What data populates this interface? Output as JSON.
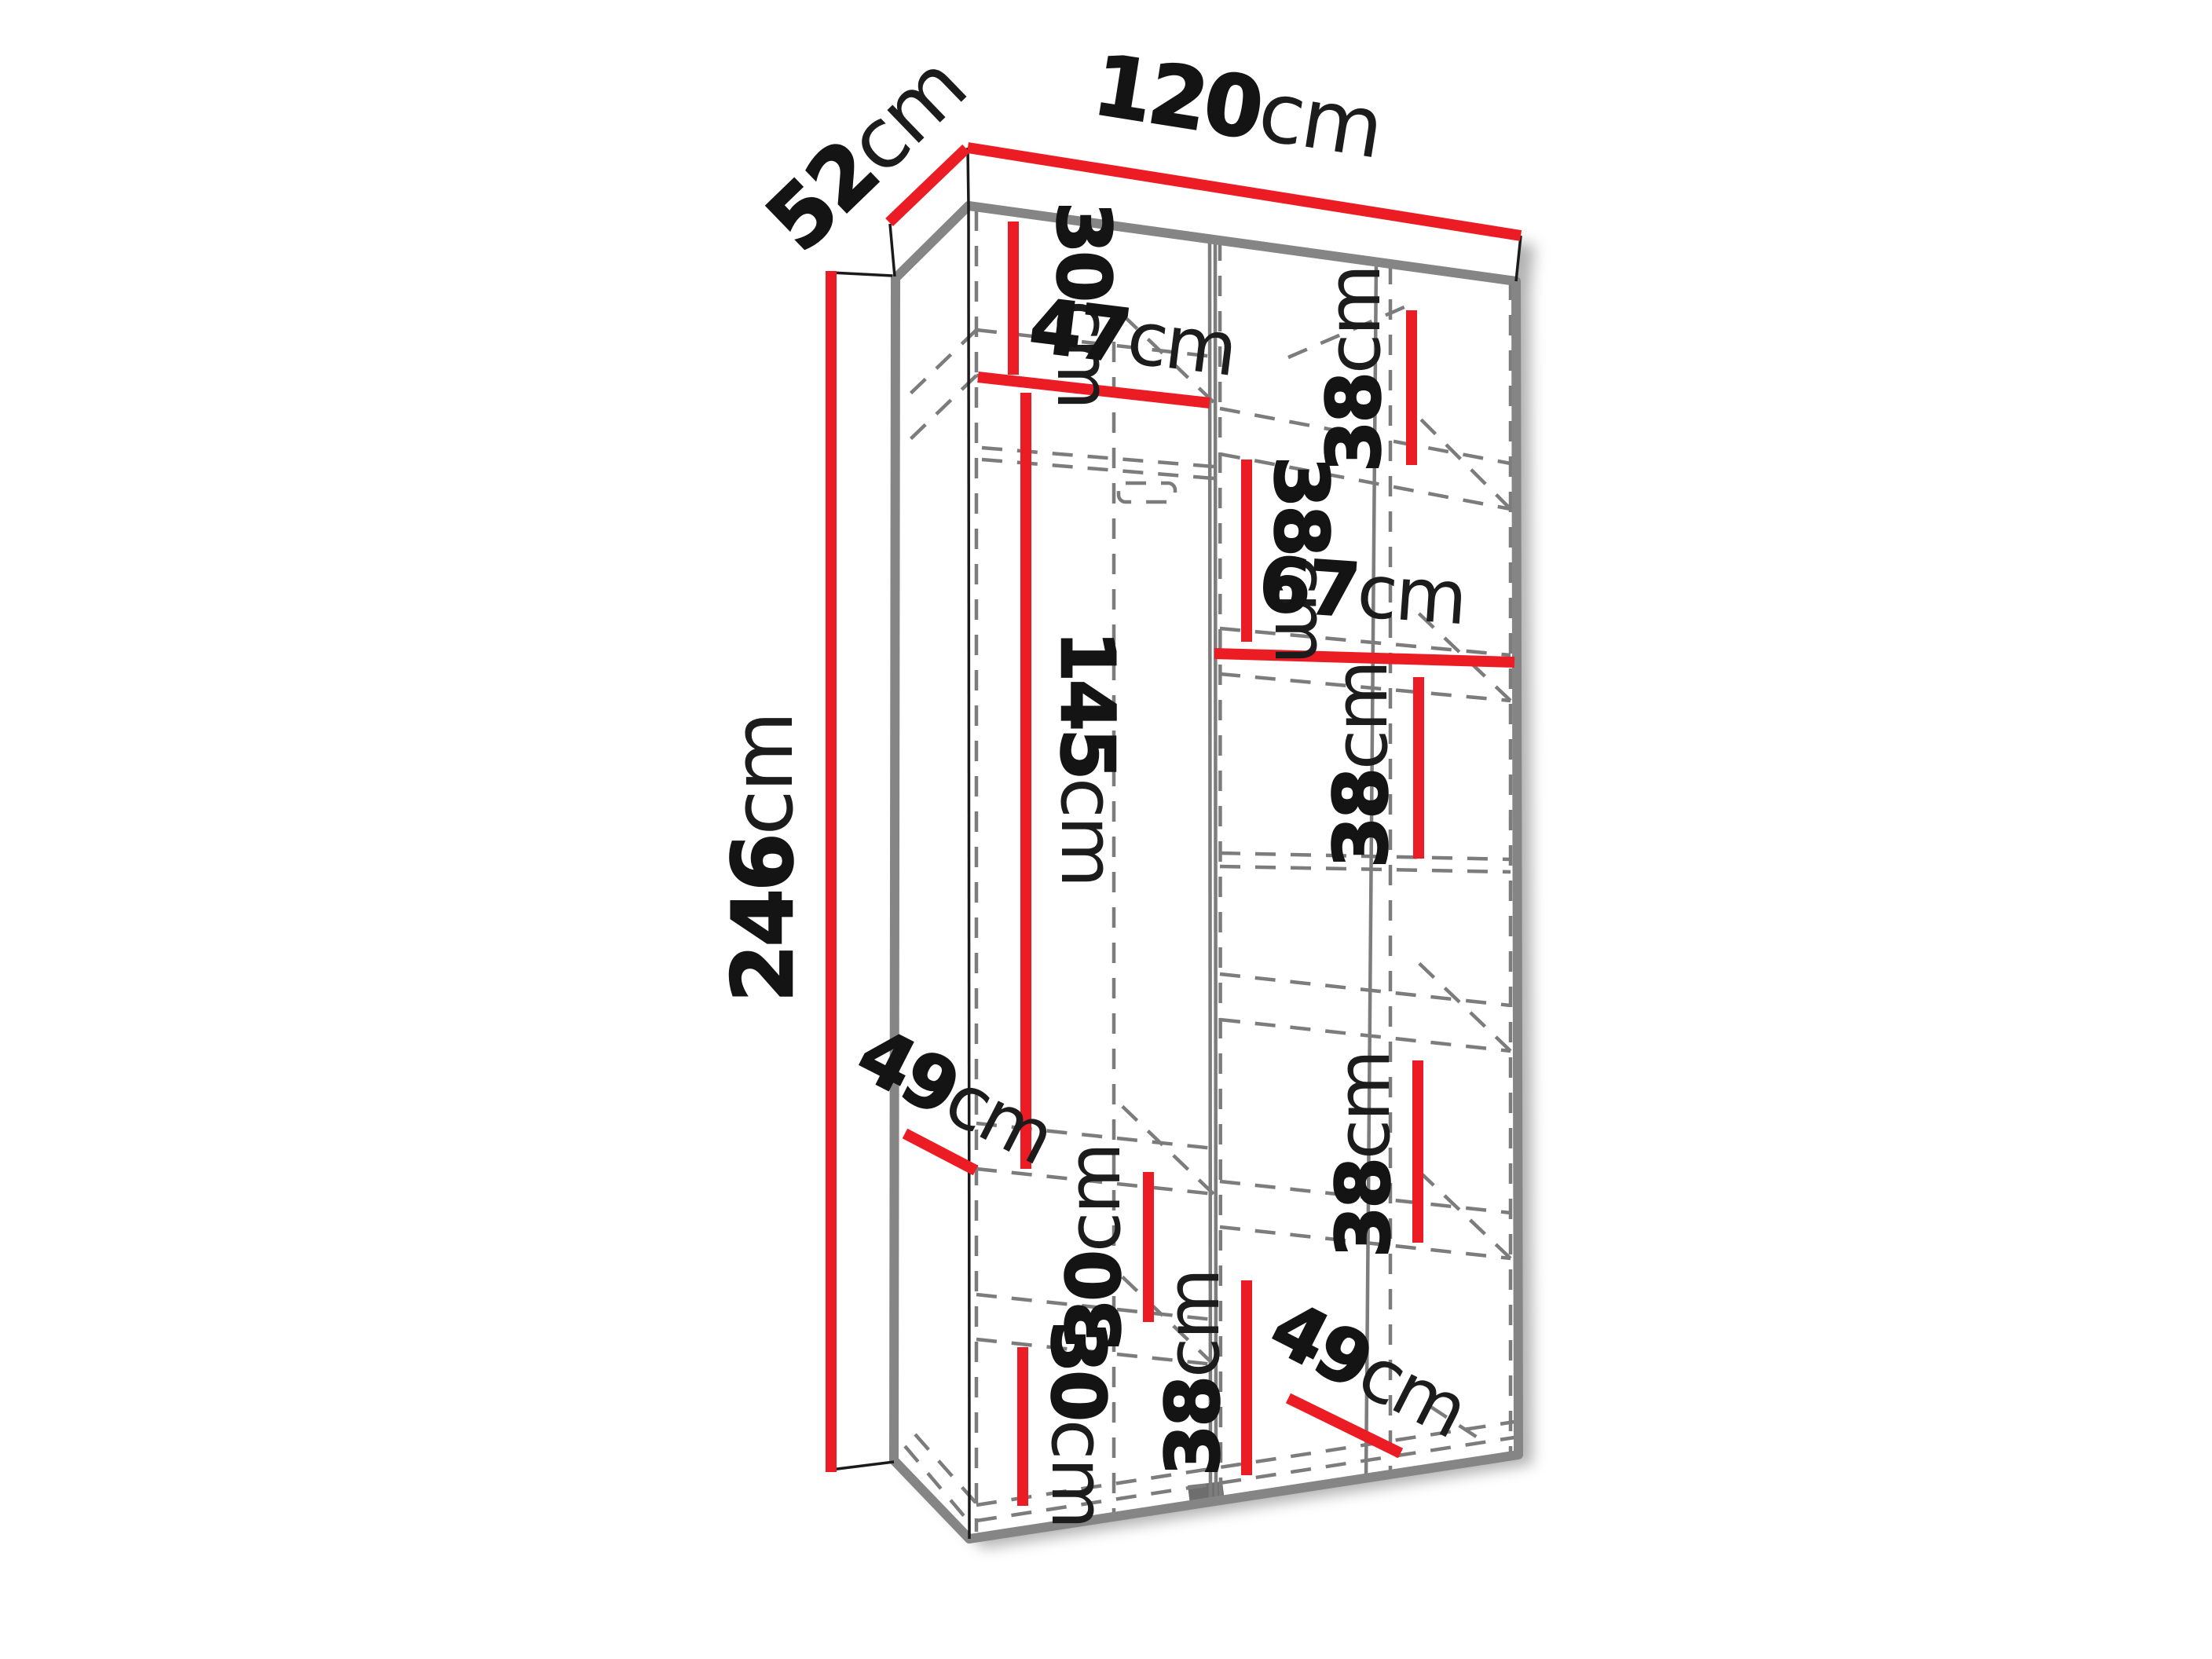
{
  "colors": {
    "background": "#ffffff",
    "dimension_red": "#ec1c24",
    "outline_gray": "#858585",
    "dashed_gray": "#7c7c7c",
    "label_black": "#141414"
  },
  "labels": [
    {
      "id": "depth-top",
      "value": "52",
      "unit": "cm"
    },
    {
      "id": "width-top",
      "value": "120",
      "unit": "cm"
    },
    {
      "id": "height-left",
      "value": "246",
      "unit": "cm"
    },
    {
      "id": "left-top-section",
      "value": "30",
      "unit": "cm"
    },
    {
      "id": "left-shelf-width",
      "value": "47",
      "unit": "cm"
    },
    {
      "id": "left-hanging-height",
      "value": "145",
      "unit": "cm"
    },
    {
      "id": "right-section-1",
      "value": "38",
      "unit": "cm"
    },
    {
      "id": "right-section-2",
      "value": "38",
      "unit": "cm"
    },
    {
      "id": "right-width",
      "value": "67",
      "unit": "cm"
    },
    {
      "id": "right-section-3",
      "value": "38",
      "unit": "cm"
    },
    {
      "id": "right-section-4",
      "value": "38",
      "unit": "cm"
    },
    {
      "id": "left-mid-section",
      "value": "30",
      "unit": "cm"
    },
    {
      "id": "left-shelf-depth",
      "value": "49",
      "unit": "cm"
    },
    {
      "id": "left-bottom-section",
      "value": "30",
      "unit": "cm"
    },
    {
      "id": "right-section-5",
      "value": "38",
      "unit": "cm"
    },
    {
      "id": "right-shelf-depth",
      "value": "49",
      "unit": "cm"
    }
  ]
}
